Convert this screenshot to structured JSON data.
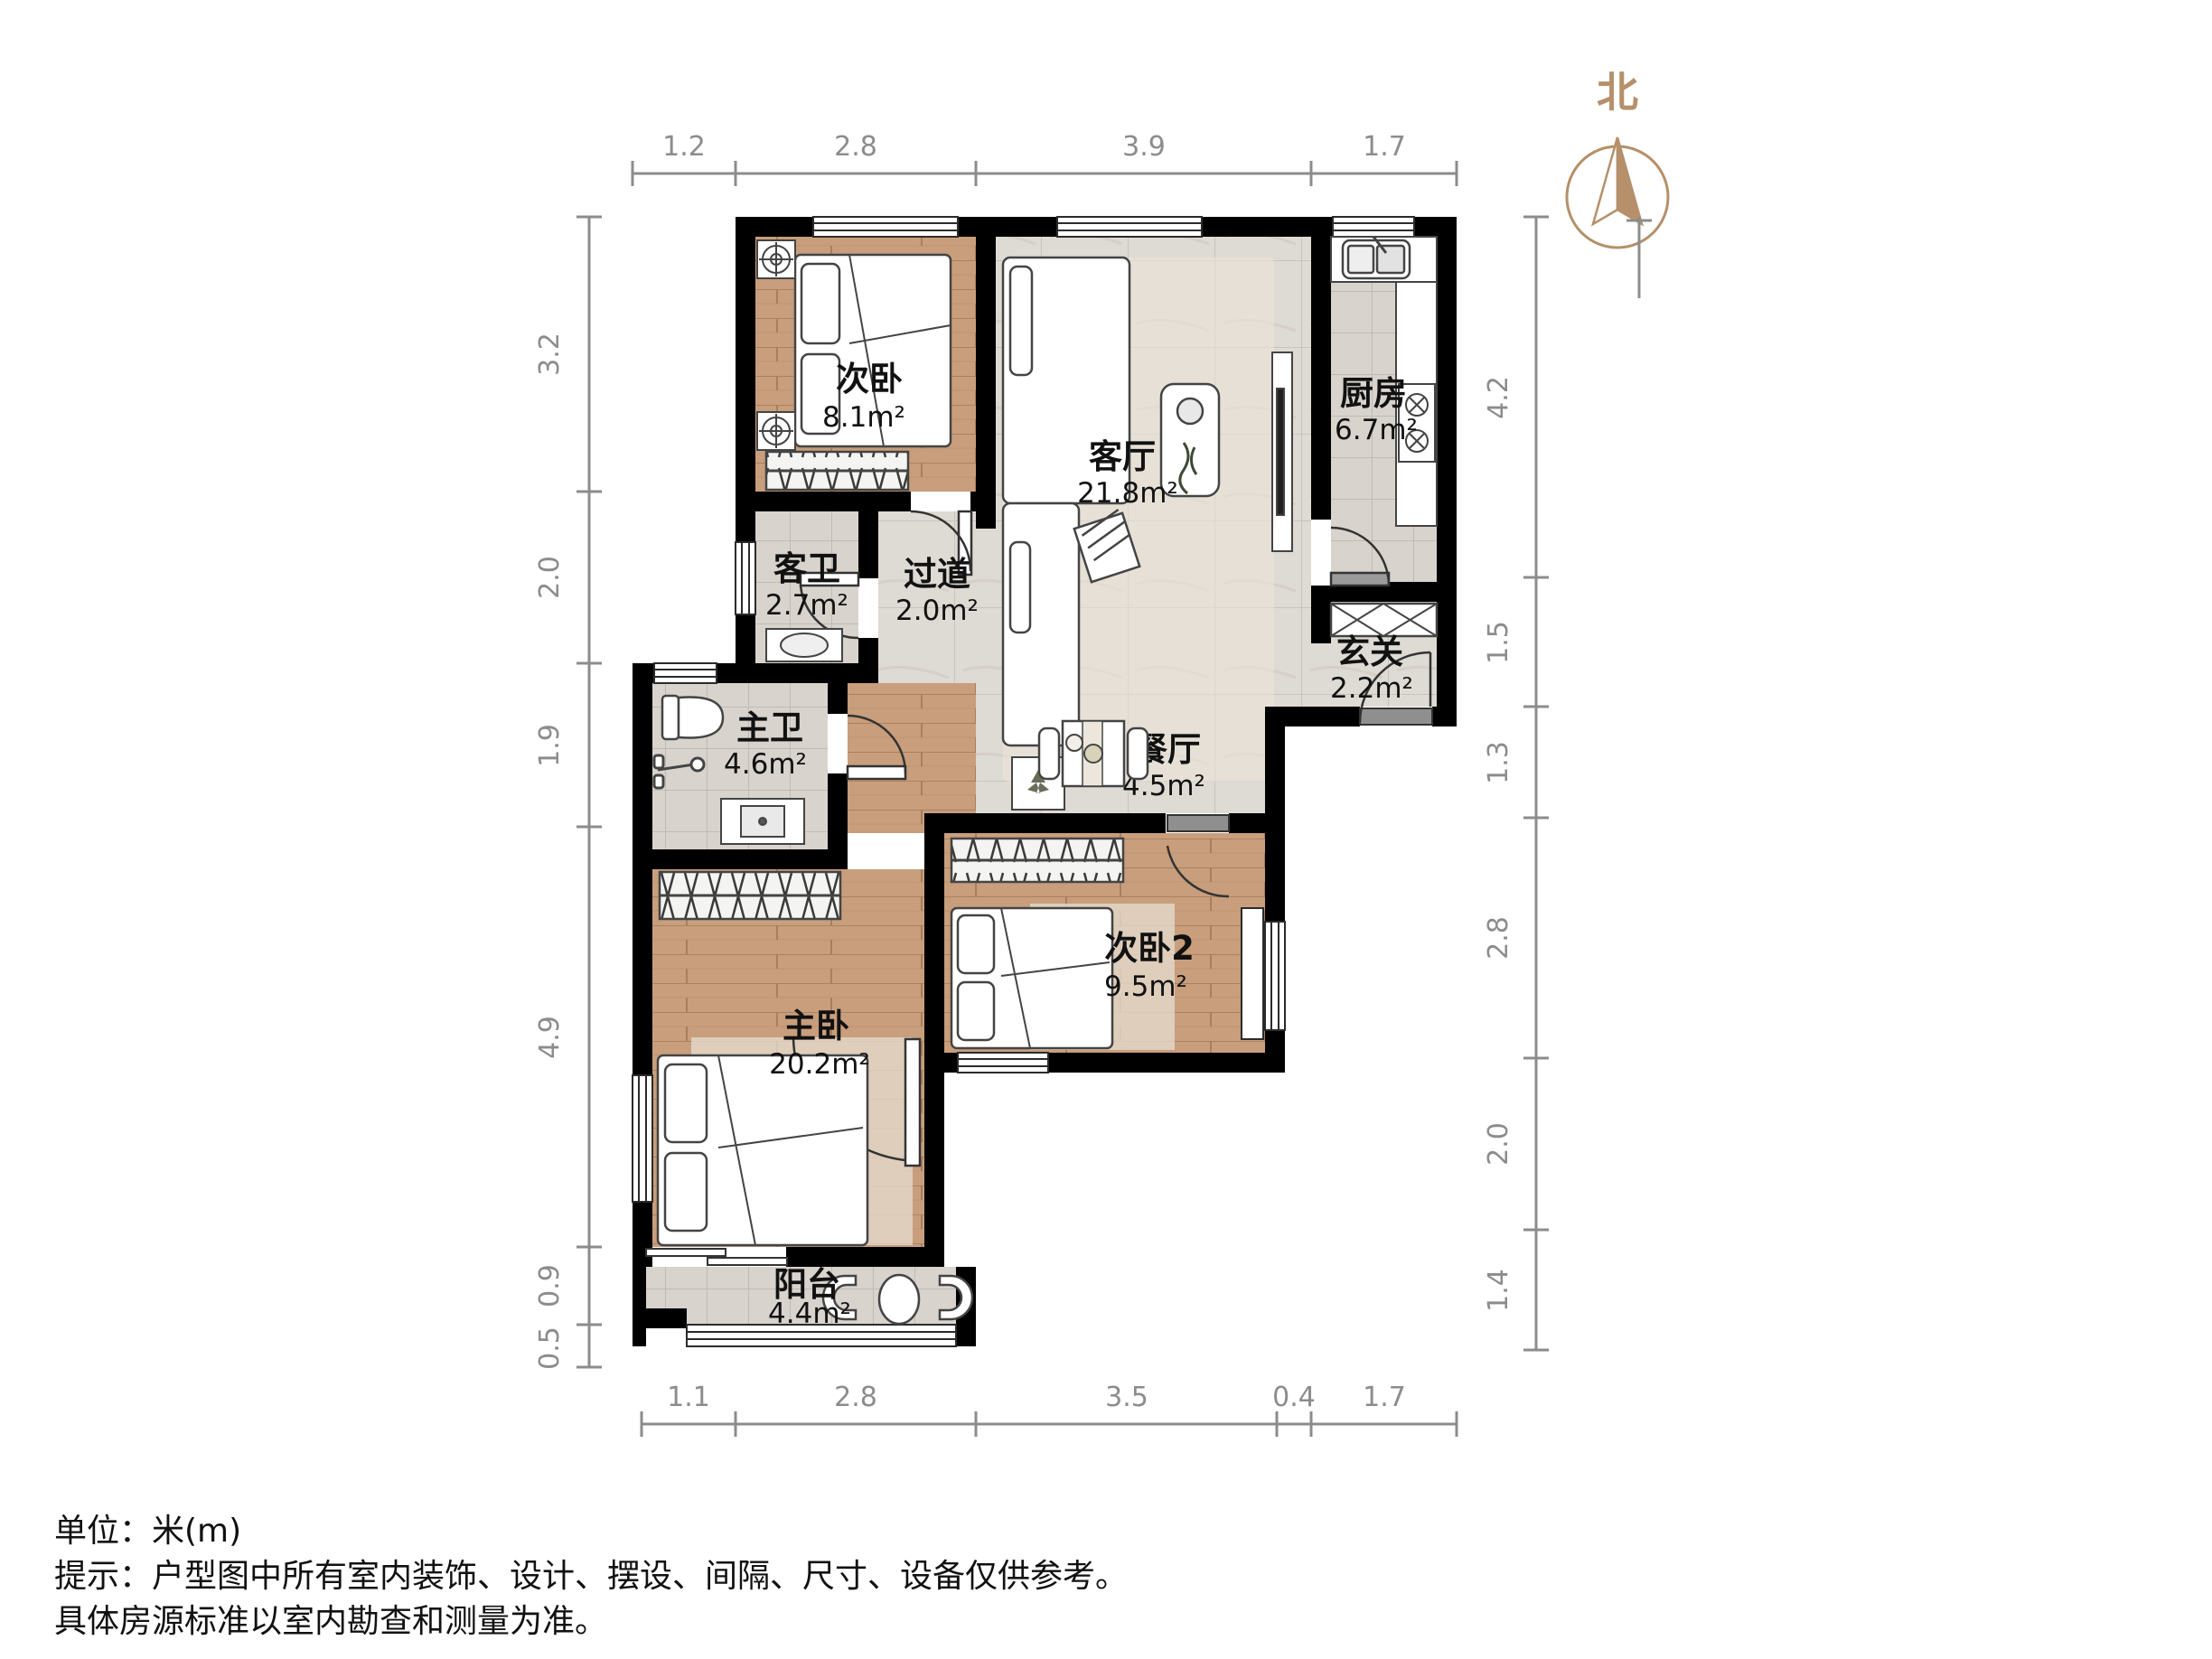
{
  "plan": {
    "north_label": "北",
    "rooms": [
      {
        "name": "次卧",
        "area": "8.1m²"
      },
      {
        "name": "客厅",
        "area": "21.8m²"
      },
      {
        "name": "厨房",
        "area": "6.7m²"
      },
      {
        "name": "客卫",
        "area": "2.7m²"
      },
      {
        "name": "过道",
        "area": "2.0m²"
      },
      {
        "name": "玄关",
        "area": "2.2m²"
      },
      {
        "name": "主卫",
        "area": "4.6m²"
      },
      {
        "name": "餐厅",
        "area": "4.5m²"
      },
      {
        "name": "主卧",
        "area": "20.2m²"
      },
      {
        "name": "次卧2",
        "area": "9.5m²"
      },
      {
        "name": "阳台",
        "area": "4.4m²"
      }
    ],
    "dimensions": {
      "top": [
        "1.2",
        "2.8",
        "3.9",
        "1.7"
      ],
      "left": [
        "3.2",
        "2.0",
        "1.9",
        "4.9",
        "0.9",
        "0.5"
      ],
      "right": [
        "4.2",
        "1.5",
        "1.3",
        "2.8",
        "2.0",
        "1.4"
      ],
      "bottom": [
        "1.1",
        "2.8",
        "3.5",
        "0.4",
        "1.7"
      ]
    }
  },
  "footer": {
    "unit_line": "单位：米(m)",
    "tip_line": "提示：户型图中所有室内装饰、设计、摆设、间隔、尺寸、设备仅供参考。",
    "tip_line2": "具体房源标准以室内勘查和测量为准。"
  },
  "colors": {
    "wall": "#000000",
    "wood_floor": "#c89e7c",
    "bath_tile": "#d8d3cd",
    "marble_tile": "#dedad4",
    "dim_line": "#8c8c8c",
    "north_accent": "#b5906a",
    "rug": "#ece5d8"
  }
}
